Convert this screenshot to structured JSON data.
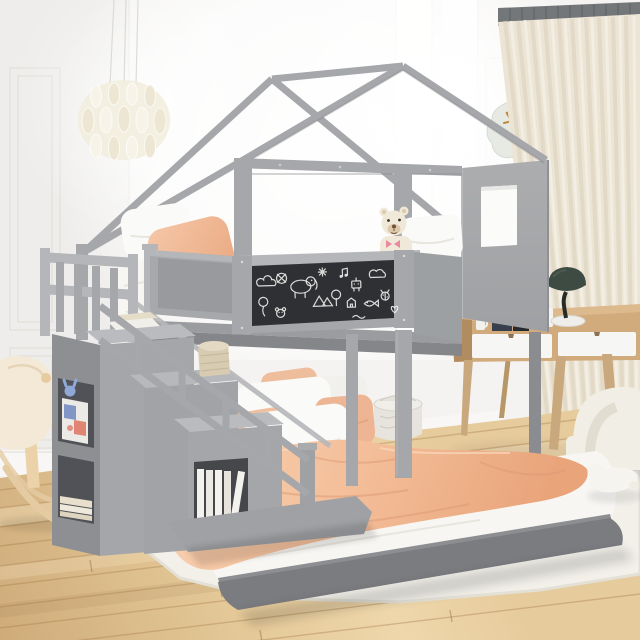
{
  "scene": {
    "title": "Kids' house-frame bunk bed in a bright bedroom",
    "description": "Gray wooden house-frame twin-over-full bunk bed with a chalkboard guardrail, storage staircase with bookshelf cubbies, peach and white bedding, a teddy bear on the top bunk, leaf-shaped wall clock, capiz chandelier, cream curtains, wooden desk with green lamp, boucle chair, rocking toy and plush toy on a white rug over an oak floor.",
    "objects": [
      "house-frame bunk bed",
      "roof frame",
      "chalkboard guardrail",
      "storage staircase",
      "bookshelf cubbies",
      "upper twin bed",
      "lower full bed",
      "peach duvet",
      "white pillows",
      "peach pillows",
      "teddy bear",
      "leaf wall clock",
      "capiz chandelier",
      "cream curtain",
      "curtain track",
      "writing desk",
      "desk drawers",
      "green desk lamp",
      "desk accessories",
      "boucle chair",
      "storage basket",
      "woven basket",
      "books",
      "rocking toy",
      "plush toy",
      "area rug",
      "oak plank floor",
      "wall moldings",
      "window light"
    ]
  },
  "chalkboard": {
    "surface": "black chalkboard panel",
    "doodles": [
      "cloud",
      "balloon",
      "teddy-face",
      "pretzel",
      "elephant",
      "sparkle",
      "tents",
      "tree",
      "music-note",
      "house",
      "robot",
      "fish",
      "cloud-2",
      "ladybug",
      "heart",
      "squiggle"
    ]
  },
  "colors": {
    "wall": "#f4f3f1",
    "wall_left": "#eeedeb",
    "molding": "#e2e1dd",
    "baseboard": "#f8f7f5",
    "frame": "#a6a7aa",
    "frame_light": "#b5b6b9",
    "frame_dark": "#8b8c90",
    "frame_deep": "#7b7c80",
    "panel": "#a7a8ab",
    "window_cut": "#fbfbfa",
    "chalk_bg": "#2f3033",
    "chalk": "#e9e9e7",
    "mattress": "#f7f6f3",
    "pillow_white": "#fafaf8",
    "peach": "#f2bf9e",
    "peach_deep": "#db9a73",
    "peach_light": "#f9d8bd",
    "teddy": "#f0e8d9",
    "teddy_shade": "#dcc9ab",
    "bow": "#e98ba0",
    "clock_face": "#e6eae3",
    "clock_hand": "#c08a3e",
    "chand": "#f2edde",
    "curtain": "#ece4d5",
    "curtain_dark": "#dcd2bf",
    "curtain_light": "#f5f0e5",
    "track": "#74777a",
    "floor": "#ddbd8e",
    "floor_light": "#eed7ab",
    "floor_dark": "#c9a878",
    "plank": "#a97f4f",
    "rug": "#f2f0e9",
    "rug_edge": "#e2dfd4",
    "desk_wood": "#d2ab7d",
    "desk_wood_dark": "#b8946a",
    "drawer": "#f6f6f4",
    "leg_wood": "#caa87e",
    "lamp": "#3d4b43",
    "lamp_dark": "#262b28",
    "lamp_base": "#efeeea",
    "chair": "#f1eee6",
    "chair_shade": "#ddd8cb",
    "basket": "#e7e4de",
    "basket_shade": "#d3d0c8",
    "book_blue": "#6f87bd",
    "book_red": "#dd6a58",
    "book_white": "#f3f2ee",
    "paper": "#e8e0cc",
    "rocker_wood": "#e5cba2",
    "rocker_seat": "#f4e9d6",
    "toy_blue": "#8fa8d6"
  }
}
